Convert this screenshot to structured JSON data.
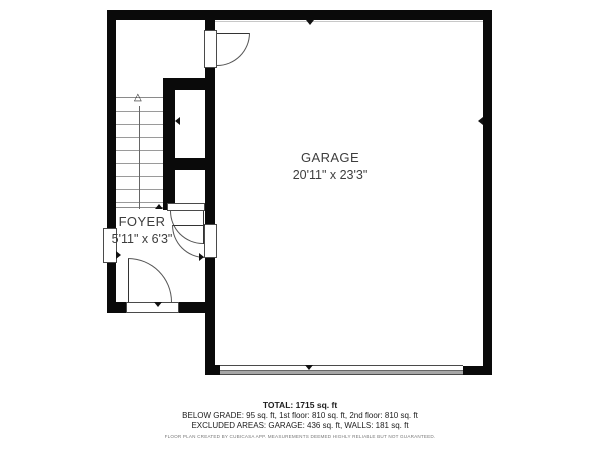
{
  "plan": {
    "rooms": [
      {
        "name": "GARAGE",
        "dimensions": "20'11\" x 23'3\""
      },
      {
        "name": "FOYER",
        "dimensions": "5'11\" x 6'3\""
      }
    ],
    "stairs": {
      "arrow_glyph": "△",
      "direction": "up"
    }
  },
  "footer": {
    "total_line": "TOTAL: 1715 sq. ft",
    "grade_line": "BELOW GRADE: 95 sq. ft, 1st floor: 810 sq. ft, 2nd floor: 810 sq. ft",
    "excluded_line": "EXCLUDED AREAS: GARAGE: 436 sq. ft, WALLS: 181 sq. ft",
    "disclaimer": "FLOOR PLAN CREATED BY CUBICASA APP. MEASUREMENTS DEEMED HIGHLY RELIABLE BUT NOT GUARANTEED."
  },
  "colors": {
    "wall": "#0a0a0a",
    "label_text": "#3d3d3d",
    "garage_door_band": "#a6a6a6"
  }
}
